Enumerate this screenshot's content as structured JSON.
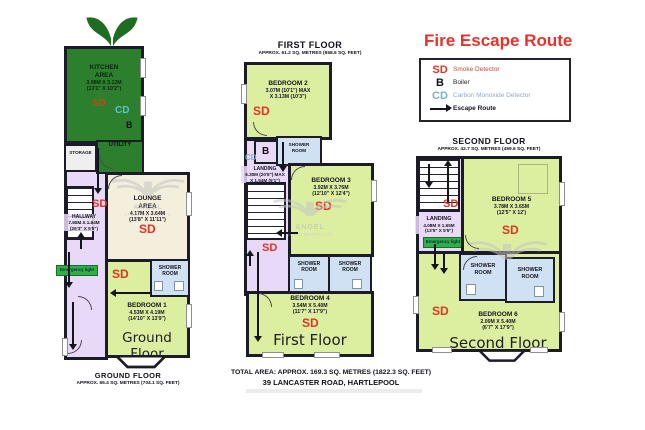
{
  "legend": {
    "title": "Fire Escape Route",
    "items": [
      {
        "symbol": "SD",
        "label": "Smoke Detector"
      },
      {
        "symbol": "B",
        "label": "Boiler"
      },
      {
        "symbol": "CD",
        "label": "Carbon Monoxide Detector"
      },
      {
        "icon": "escape-route-arrow",
        "label": "Escape Route"
      }
    ]
  },
  "markers": {
    "sd": "SD",
    "b": "B",
    "cd": "CD",
    "emergency": "Emergency light",
    "shower": "SHOWER\nROOM",
    "storage": "STORAGE",
    "utility": "UTILITY"
  },
  "watermark": {
    "name": "ANGEL",
    "sub": "APARTMENTS LTD"
  },
  "ground": {
    "heading": "GROUND FLOOR",
    "area": "APPROX. 65.4 SQ. METRES (704.1 SQ. FEET)",
    "label": "Ground Floor",
    "kitchen": {
      "name": "KITCHEN\nAREA",
      "m": "3.98M X 3.12M",
      "ft": "(13'1\" X 10'2\")"
    },
    "lounge": {
      "name": "LOUNGE\nAREA",
      "m": "4.17M X 3.64M",
      "ft": "(13'8\" X 11'11\")"
    },
    "hallway": {
      "name": "HALLWAY",
      "m": "7.90M X 1.64M",
      "ft": "(26'3\" X 5'5\")"
    },
    "bedroom1": {
      "name": "BEDROOM 1",
      "m": "4.53M X 4.19M",
      "ft": "(14'10\" X 13'9\")"
    }
  },
  "first": {
    "heading": "FIRST FLOOR",
    "area": "APPROX. 61.2 SQ. METRES (658.6 SQ. FEET)",
    "label": "First Floor",
    "bedroom2": {
      "name": "BEDROOM 2",
      "m": "3.07M (10'1\") MAX",
      "ft": "X 3.13M (10'3\")"
    },
    "landing": {
      "name": "LANDING",
      "m": "6.30M (20'8\") MAX",
      "ft": "X 1.54M (5'1\")"
    },
    "bedroom3": {
      "name": "BEDROOM 3",
      "m": "3.92M X 3.76M",
      "ft": "(12'10\" X 12'4\")"
    },
    "bedroom4": {
      "name": "BEDROOM 4",
      "m": "3.54M X 5.40M",
      "ft": "(11'7\" X 17'9\")"
    }
  },
  "second": {
    "heading": "SECOND FLOOR",
    "area": "APPROX. 42.7 SQ. METRES (459.6 SQ. FEET)",
    "label": "Second Floor",
    "landing": {
      "name": "LANDING",
      "m": "4.08M X 1.65M",
      "ft": "(13'5\" X 5'5\")"
    },
    "bedroom5": {
      "name": "BEDROOM 5",
      "m": "3.78M X 3.65M",
      "ft": "(12'5\" X 12')"
    },
    "bedroom6": {
      "name": "BEDROOM 6",
      "m": "2.00M X 5.40M",
      "ft": "(6'7\" X 17'9\")"
    }
  },
  "footer": {
    "total": "TOTAL AREA: APPROX. 169.3 SQ. METRES (1822.3 SQ. FEET)",
    "address": "39 LANCASTER ROAD, HARTLEPOOL"
  },
  "colors": {
    "escape_red": "#e43226",
    "cd_blue": "#7bafd4",
    "kitchen_green": "#2c7f2c",
    "bedroom_green": "#dcefa0",
    "hallway_lilac": "#e8d9f8",
    "lounge_cream": "#f4eedd",
    "shower_blue": "#cfe1f2",
    "emergency_green": "#2fae4a",
    "wall": "#1c1c28"
  }
}
